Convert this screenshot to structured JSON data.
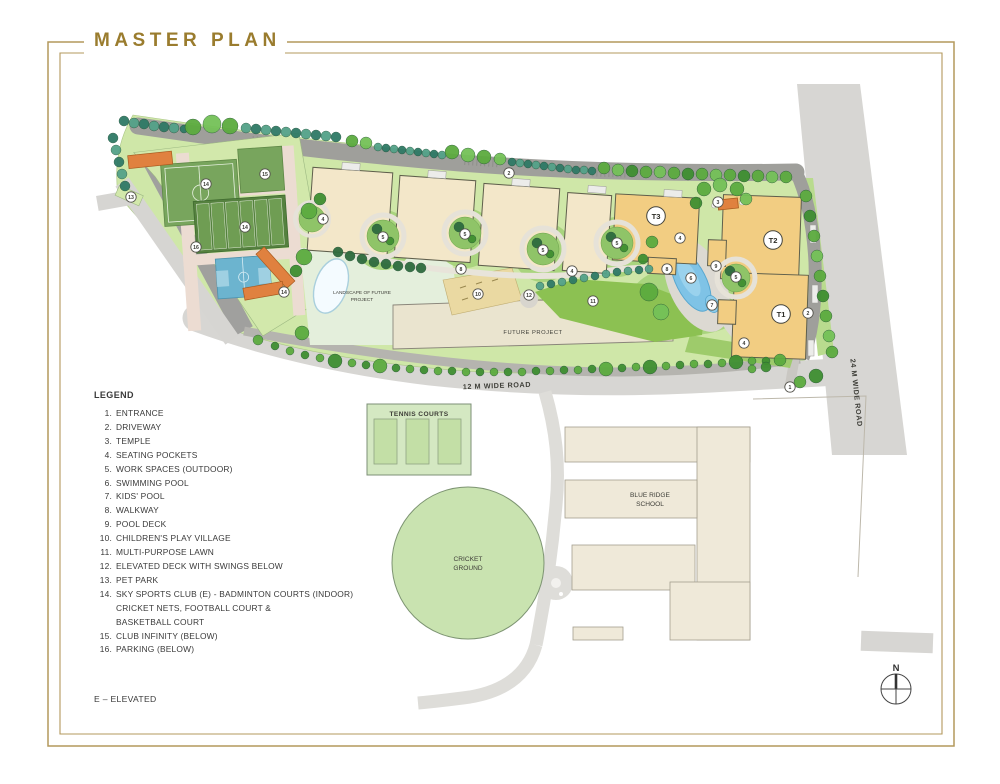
{
  "title": "MASTER PLAN",
  "legend": {
    "title": "LEGEND",
    "items": [
      {
        "num": "1.",
        "text": "ENTRANCE"
      },
      {
        "num": "2.",
        "text": "DRIVEWAY"
      },
      {
        "num": "3.",
        "text": "TEMPLE"
      },
      {
        "num": "4.",
        "text": "SEATING POCKETS"
      },
      {
        "num": "5.",
        "text": "WORK SPACES (OUTDOOR)"
      },
      {
        "num": "6.",
        "text": "SWIMMING POOL"
      },
      {
        "num": "7.",
        "text": "KIDS' POOL"
      },
      {
        "num": "8.",
        "text": "WALKWAY"
      },
      {
        "num": "9.",
        "text": "POOL DECK"
      },
      {
        "num": "10.",
        "text": "CHILDREN'S PLAY VILLAGE"
      },
      {
        "num": "11.",
        "text": "MULTI-PURPOSE LAWN"
      },
      {
        "num": "12.",
        "text": "ELEVATED DECK WITH SWINGS BELOW"
      },
      {
        "num": "13.",
        "text": "PET PARK"
      },
      {
        "num": "14.",
        "text": "SKY SPORTS CLUB (E) - BADMINTON COURTS (INDOOR)",
        "lines": [
          "CRICKET NETS, FOOTBALL COURT &",
          "BASKETBALL COURT"
        ]
      },
      {
        "num": "15.",
        "text": "CLUB INFINITY (BELOW)"
      },
      {
        "num": "16.",
        "text": "PARKING (BELOW)"
      }
    ],
    "note": "E – ELEVATED"
  },
  "map": {
    "roads": {
      "road_12m": "12 M WIDE ROAD",
      "road_24m": "24 M WIDE ROAD"
    },
    "areas": {
      "tennis": "TENNIS COURTS",
      "cricket_line1": "CRICKET",
      "cricket_line2": "GROUND",
      "school_line1": "BLUE RIDGE",
      "school_line2": "SCHOOL",
      "future_project": "FUTURE PROJECT",
      "landscape_line1": "LANDSCAPE OF FUTURE",
      "landscape_line2": "PROJECT"
    },
    "towers": [
      {
        "label": "T3",
        "x": 656,
        "y": 216
      },
      {
        "label": "T2",
        "x": 773,
        "y": 240
      },
      {
        "label": "T1",
        "x": 781,
        "y": 314
      }
    ],
    "markers": [
      {
        "n": "13",
        "x": 131,
        "y": 197
      },
      {
        "n": "14",
        "x": 206,
        "y": 184
      },
      {
        "n": "15",
        "x": 265,
        "y": 174
      },
      {
        "n": "14",
        "x": 245,
        "y": 227
      },
      {
        "n": "16",
        "x": 196,
        "y": 247
      },
      {
        "n": "14",
        "x": 284,
        "y": 292
      },
      {
        "n": "4",
        "x": 323,
        "y": 219
      },
      {
        "n": "5",
        "x": 383,
        "y": 237
      },
      {
        "n": "5",
        "x": 465,
        "y": 234
      },
      {
        "n": "5",
        "x": 543,
        "y": 250
      },
      {
        "n": "5",
        "x": 617,
        "y": 243
      },
      {
        "n": "2",
        "x": 509,
        "y": 173
      },
      {
        "n": "8",
        "x": 461,
        "y": 269
      },
      {
        "n": "10",
        "x": 478,
        "y": 294
      },
      {
        "n": "12",
        "x": 529,
        "y": 295
      },
      {
        "n": "11",
        "x": 593,
        "y": 301
      },
      {
        "n": "4",
        "x": 572,
        "y": 271
      },
      {
        "n": "4",
        "x": 680,
        "y": 238
      },
      {
        "n": "3",
        "x": 718,
        "y": 202
      },
      {
        "n": "9",
        "x": 716,
        "y": 266
      },
      {
        "n": "5",
        "x": 736,
        "y": 277
      },
      {
        "n": "6",
        "x": 691,
        "y": 278
      },
      {
        "n": "7",
        "x": 712,
        "y": 305
      },
      {
        "n": "8",
        "x": 667,
        "y": 269
      },
      {
        "n": "4",
        "x": 744,
        "y": 343
      },
      {
        "n": "2",
        "x": 808,
        "y": 313
      },
      {
        "n": "1",
        "x": 790,
        "y": 387
      }
    ],
    "compass_n": "N"
  },
  "colors": {
    "frame": "#b3985c",
    "title_gold": "#9a7c2e",
    "road_dark": "#9f9f9b",
    "road_light": "#d7d6d3",
    "site_green": "#cfe7a8",
    "lawn_green": "#8cc152",
    "building_beige": "#f3e7c9",
    "tower_orange": "#f2cd82",
    "pool_blue": "#7fc3e6",
    "court_teal": "#6cb4cf",
    "court_green": "#78a55d",
    "orange_roof": "#e0813f",
    "sand": "#ead9a2",
    "pale_area": "#efe9d9"
  }
}
